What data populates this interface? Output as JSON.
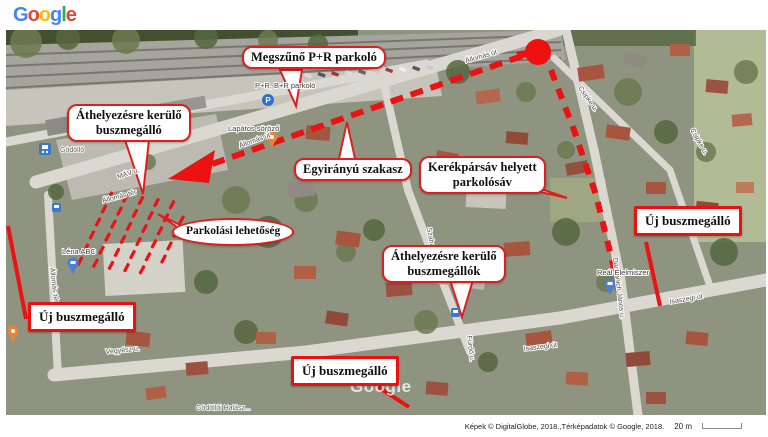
{
  "logo": {
    "letters": [
      {
        "ch": "G",
        "color": "#4285F4"
      },
      {
        "ch": "o",
        "color": "#EA4335"
      },
      {
        "ch": "o",
        "color": "#FBBC05"
      },
      {
        "ch": "g",
        "color": "#4285F4"
      },
      {
        "ch": "l",
        "color": "#34A853"
      },
      {
        "ch": "e",
        "color": "#EA4335"
      }
    ]
  },
  "colors": {
    "annotation_red": "#ea1212",
    "callout_border": "#de1f1f"
  },
  "callouts": [
    {
      "id": "megszuno-pr-parkolo",
      "shape": "bubble",
      "x": 236,
      "y": 16,
      "text": "Megszűnő P+R parkoló"
    },
    {
      "id": "athelyezesre-buszmegallo",
      "shape": "bubble",
      "x": 61,
      "y": 74,
      "text": "Áthelyezésre kerülő\nbuszmegálló"
    },
    {
      "id": "egyiranyu-szakasz",
      "shape": "bubble",
      "x": 288,
      "y": 128,
      "text": "Egyirányú szakasz"
    },
    {
      "id": "kerekparsav-parkolosav",
      "shape": "bubble",
      "x": 413,
      "y": 126,
      "text": "Kerékpársáv helyett\nparkolósáv"
    },
    {
      "id": "parkolasi-lehetoseg",
      "shape": "ellipse",
      "x": 166,
      "y": 188,
      "text": "Parkolási lehetőség"
    },
    {
      "id": "athelyezesre-buszmegallok",
      "shape": "bubble",
      "x": 376,
      "y": 215,
      "text": "Áthelyezésre kerülő\nbuszmegállók"
    },
    {
      "id": "uj-buszmegallo-jobb",
      "shape": "box",
      "x": 628,
      "y": 176,
      "text": "Új buszmegálló"
    },
    {
      "id": "uj-buszmegallo-bal",
      "shape": "box",
      "x": 22,
      "y": 272,
      "text": "Új buszmegálló"
    },
    {
      "id": "uj-buszmegallo-also",
      "shape": "box",
      "x": 285,
      "y": 326,
      "text": "Új buszmegálló"
    }
  ],
  "map": {
    "watermark": "Google",
    "streets": [
      {
        "text": "Állomás út",
        "x": 460,
        "y": 33,
        "rot": -16
      },
      {
        "text": "Állomás út",
        "x": 234,
        "y": 118,
        "rot": -20
      },
      {
        "text": "MÁV u.",
        "x": 112,
        "y": 149,
        "rot": -18
      },
      {
        "text": "Állomás tér",
        "x": 97,
        "y": 173,
        "rot": -15
      },
      {
        "text": "Állomás tér",
        "x": 44,
        "y": 238,
        "rot": 83
      },
      {
        "text": "Csipke u.",
        "x": 572,
        "y": 58,
        "rot": 55
      },
      {
        "text": "Csipke u.",
        "x": 684,
        "y": 100,
        "rot": 60
      },
      {
        "text": "Damjanich János u.",
        "x": 607,
        "y": 228,
        "rot": 83
      },
      {
        "text": "Szabadság út",
        "x": 421,
        "y": 198,
        "rot": 80
      },
      {
        "text": "Fürdő u.",
        "x": 461,
        "y": 306,
        "rot": 83
      },
      {
        "text": "Isaszegi út",
        "x": 518,
        "y": 321,
        "rot": -7
      },
      {
        "text": "Isaszegi út",
        "x": 664,
        "y": 274,
        "rot": -10
      },
      {
        "text": "Vegyész u.",
        "x": 100,
        "y": 324,
        "rot": -6
      }
    ],
    "pois": [
      {
        "text": "Gödöllő",
        "x": 54,
        "y": 122,
        "cls": "poi-light"
      },
      {
        "text": "P+R, B+R parkoló",
        "x": 249,
        "y": 58,
        "cls": "poi"
      },
      {
        "text": "Lapátos söröző",
        "x": 222,
        "y": 101,
        "cls": "poi"
      },
      {
        "text": "Léna ABC",
        "x": 56,
        "y": 224,
        "cls": "poi"
      },
      {
        "text": "Reál Élelmiszer",
        "x": 591,
        "y": 245,
        "cls": "poi"
      },
      {
        "text": "Gödöllői Halász...",
        "x": 190,
        "y": 380,
        "cls": "poi-light"
      }
    ]
  },
  "footer": {
    "attribution": "Képek © DigitalGlobe, 2018.,Térképadatok © Google, 2018.",
    "scale_label": "20 m"
  }
}
